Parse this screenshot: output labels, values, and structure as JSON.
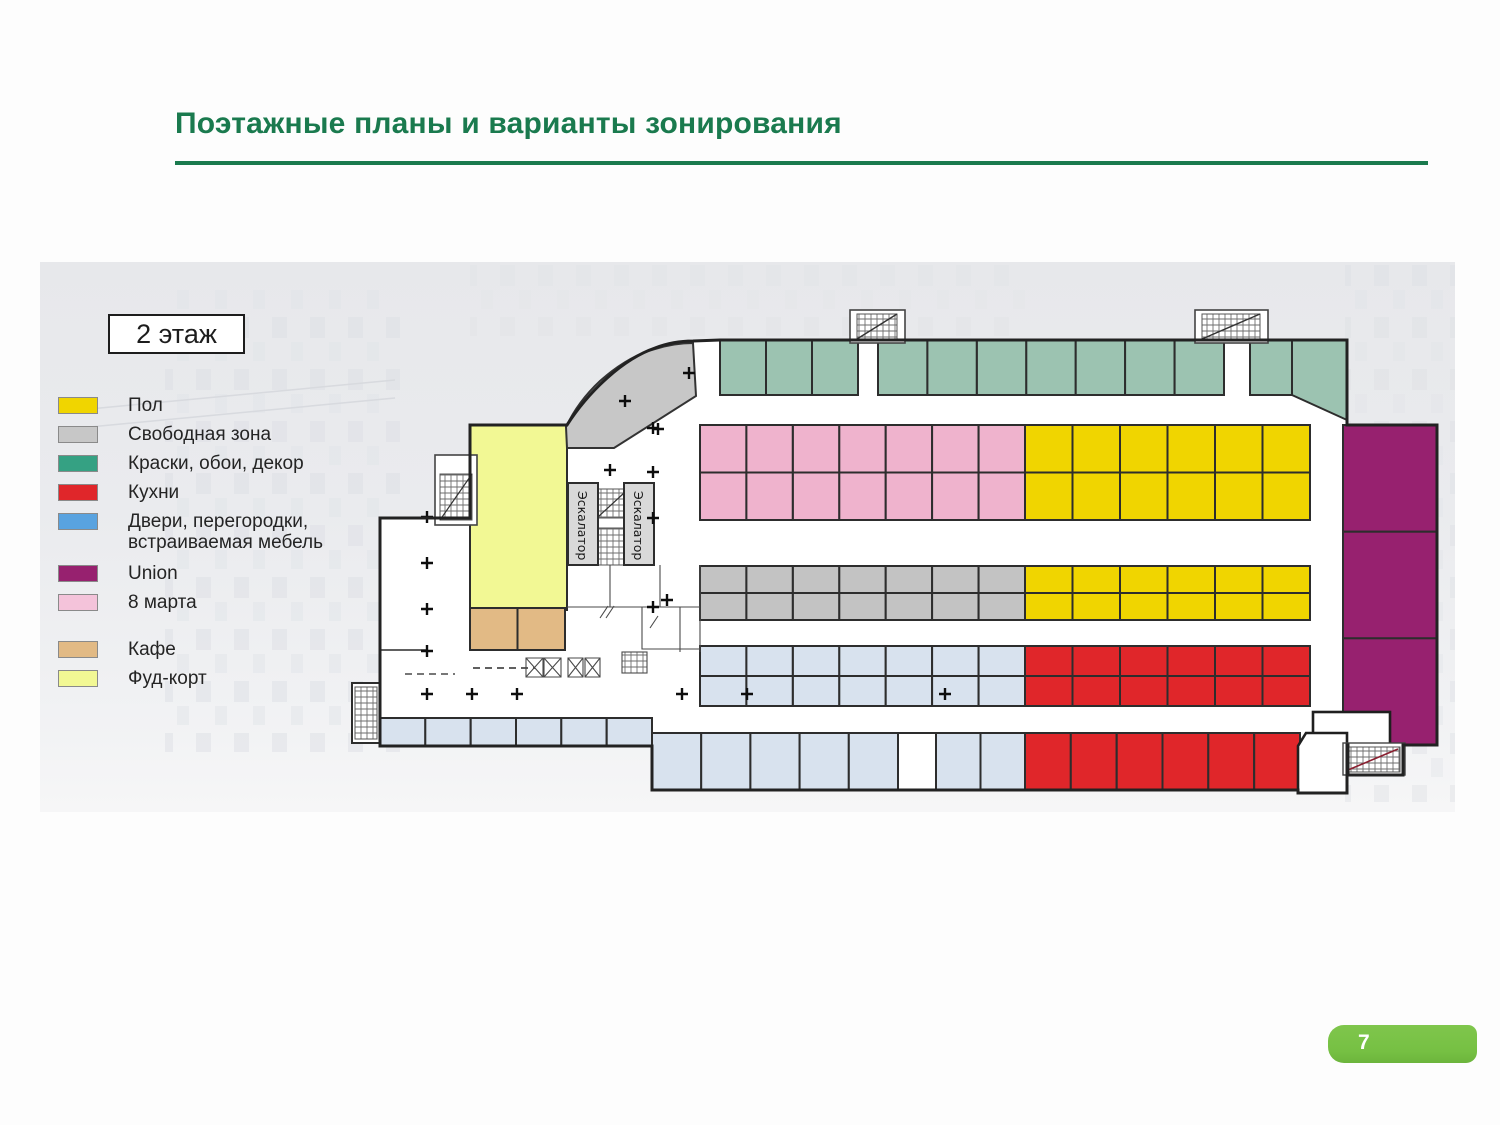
{
  "title": "Поэтажные планы и варианты зонирования",
  "floor_label": "2 этаж",
  "page_number": "7",
  "plan_labels": {
    "escalator": "Эскалатор"
  },
  "legend": {
    "items": [
      {
        "name": "legend-floor",
        "label": "Пол",
        "color": "#f0d500",
        "extra_gap": 0
      },
      {
        "name": "legend-free-zone",
        "label": "Свободная зона",
        "color": "#c7c7c7",
        "extra_gap": 0
      },
      {
        "name": "legend-paints",
        "label": "Краски, обои, декор",
        "color": "#35a183",
        "extra_gap": 0
      },
      {
        "name": "legend-kitchens",
        "label": "Кухни",
        "color": "#e0262a",
        "extra_gap": 0
      },
      {
        "name": "legend-doors",
        "label": "Двери, перегородки,\nвстраиваемая мебель",
        "color": "#59a3e0",
        "extra_gap": 0
      },
      {
        "name": "legend-union",
        "label": "Union",
        "color": "#97216f",
        "extra_gap": 10
      },
      {
        "name": "legend-march8",
        "label": "8 марта",
        "color": "#f4c3da",
        "extra_gap": 0
      },
      {
        "name": "legend-cafe",
        "label": "Кафе",
        "color": "#e2ba85",
        "extra_gap": 26
      },
      {
        "name": "legend-food-court",
        "label": "Фуд-корт",
        "color": "#f2f894",
        "extra_gap": 0
      }
    ]
  },
  "colors": {
    "title_green": "#1a7a4e",
    "badge_green": "#76c043",
    "cell_stroke": "#2d2d2d",
    "outline": "#222222",
    "floor_plan": "#f0d500",
    "free_plan": "#c3c3c3",
    "free_zone_band": "#c7c7c7",
    "paints_plan": "#9cc3b1",
    "kitchens_plan": "#e0262a",
    "doors_plan": "#d8e2ee",
    "union_plan": "#97216f",
    "march8_plan": "#efb3cd",
    "food_court": "#f2f894",
    "cafe": "#e2ba85",
    "white": "#ffffff"
  },
  "plan": {
    "strips": [
      {
        "name": "paints-row-a",
        "x": 680,
        "y": 78,
        "w": 138,
        "h": 55,
        "cols": 3,
        "rows": 1,
        "color": "paints_plan"
      },
      {
        "name": "paints-row-b",
        "x": 838,
        "y": 78,
        "w": 346,
        "h": 55,
        "cols": 7,
        "rows": 1,
        "color": "paints_plan"
      },
      {
        "name": "paints-row-c",
        "x": 1210,
        "y": 78,
        "w": 42,
        "h": 55,
        "cols": 1,
        "rows": 1,
        "color": "paints_plan"
      },
      {
        "name": "march8-zone",
        "x": 660,
        "y": 163,
        "w": 325,
        "h": 95,
        "cols": 7,
        "rows": 2,
        "color": "march8_plan"
      },
      {
        "name": "floor-zone-upper",
        "x": 985,
        "y": 163,
        "w": 285,
        "h": 95,
        "cols": 6,
        "rows": 2,
        "color": "floor_plan"
      },
      {
        "name": "free-zone-row",
        "x": 660,
        "y": 304,
        "w": 325,
        "h": 54,
        "cols": 7,
        "rows": 2,
        "color": "free_plan"
      },
      {
        "name": "floor-zone-lower",
        "x": 985,
        "y": 304,
        "w": 285,
        "h": 54,
        "cols": 6,
        "rows": 2,
        "color": "floor_plan"
      },
      {
        "name": "doors-zone-upper",
        "x": 660,
        "y": 384,
        "w": 325,
        "h": 60,
        "cols": 7,
        "rows": 2,
        "color": "doors_plan"
      },
      {
        "name": "kitchens-zone-upper",
        "x": 985,
        "y": 384,
        "w": 285,
        "h": 60,
        "cols": 6,
        "rows": 2,
        "color": "kitchens_plan"
      },
      {
        "name": "doors-bottom-a",
        "x": 612,
        "y": 471,
        "w": 246,
        "h": 57,
        "cols": 5,
        "rows": 1,
        "color": "doors_plan"
      },
      {
        "name": "bottom-white-cell",
        "x": 858,
        "y": 471,
        "w": 38,
        "h": 57,
        "cols": 1,
        "rows": 1,
        "color": "white"
      },
      {
        "name": "doors-bottom-b",
        "x": 896,
        "y": 471,
        "w": 89,
        "h": 57,
        "cols": 2,
        "rows": 1,
        "color": "doors_plan"
      },
      {
        "name": "kitchens-bottom",
        "x": 985,
        "y": 471,
        "w": 275,
        "h": 57,
        "cols": 6,
        "rows": 1,
        "color": "kitchens_plan"
      },
      {
        "name": "doors-left-row",
        "x": 340,
        "y": 456,
        "w": 272,
        "h": 28,
        "cols": 6,
        "rows": 1,
        "color": "doors_plan"
      },
      {
        "name": "union-zone",
        "x": 1303,
        "y": 163,
        "w": 94,
        "h": 320,
        "cols": 1,
        "rows": 3,
        "color": "union_plan"
      },
      {
        "name": "food-court-zone",
        "x": 430,
        "y": 163,
        "w": 97,
        "h": 185,
        "cols": 1,
        "rows": 1,
        "color": "food_court"
      },
      {
        "name": "cafe-zone",
        "x": 430,
        "y": 346,
        "w": 95,
        "h": 42,
        "cols": 2,
        "rows": 1,
        "color": "cafe"
      }
    ]
  }
}
